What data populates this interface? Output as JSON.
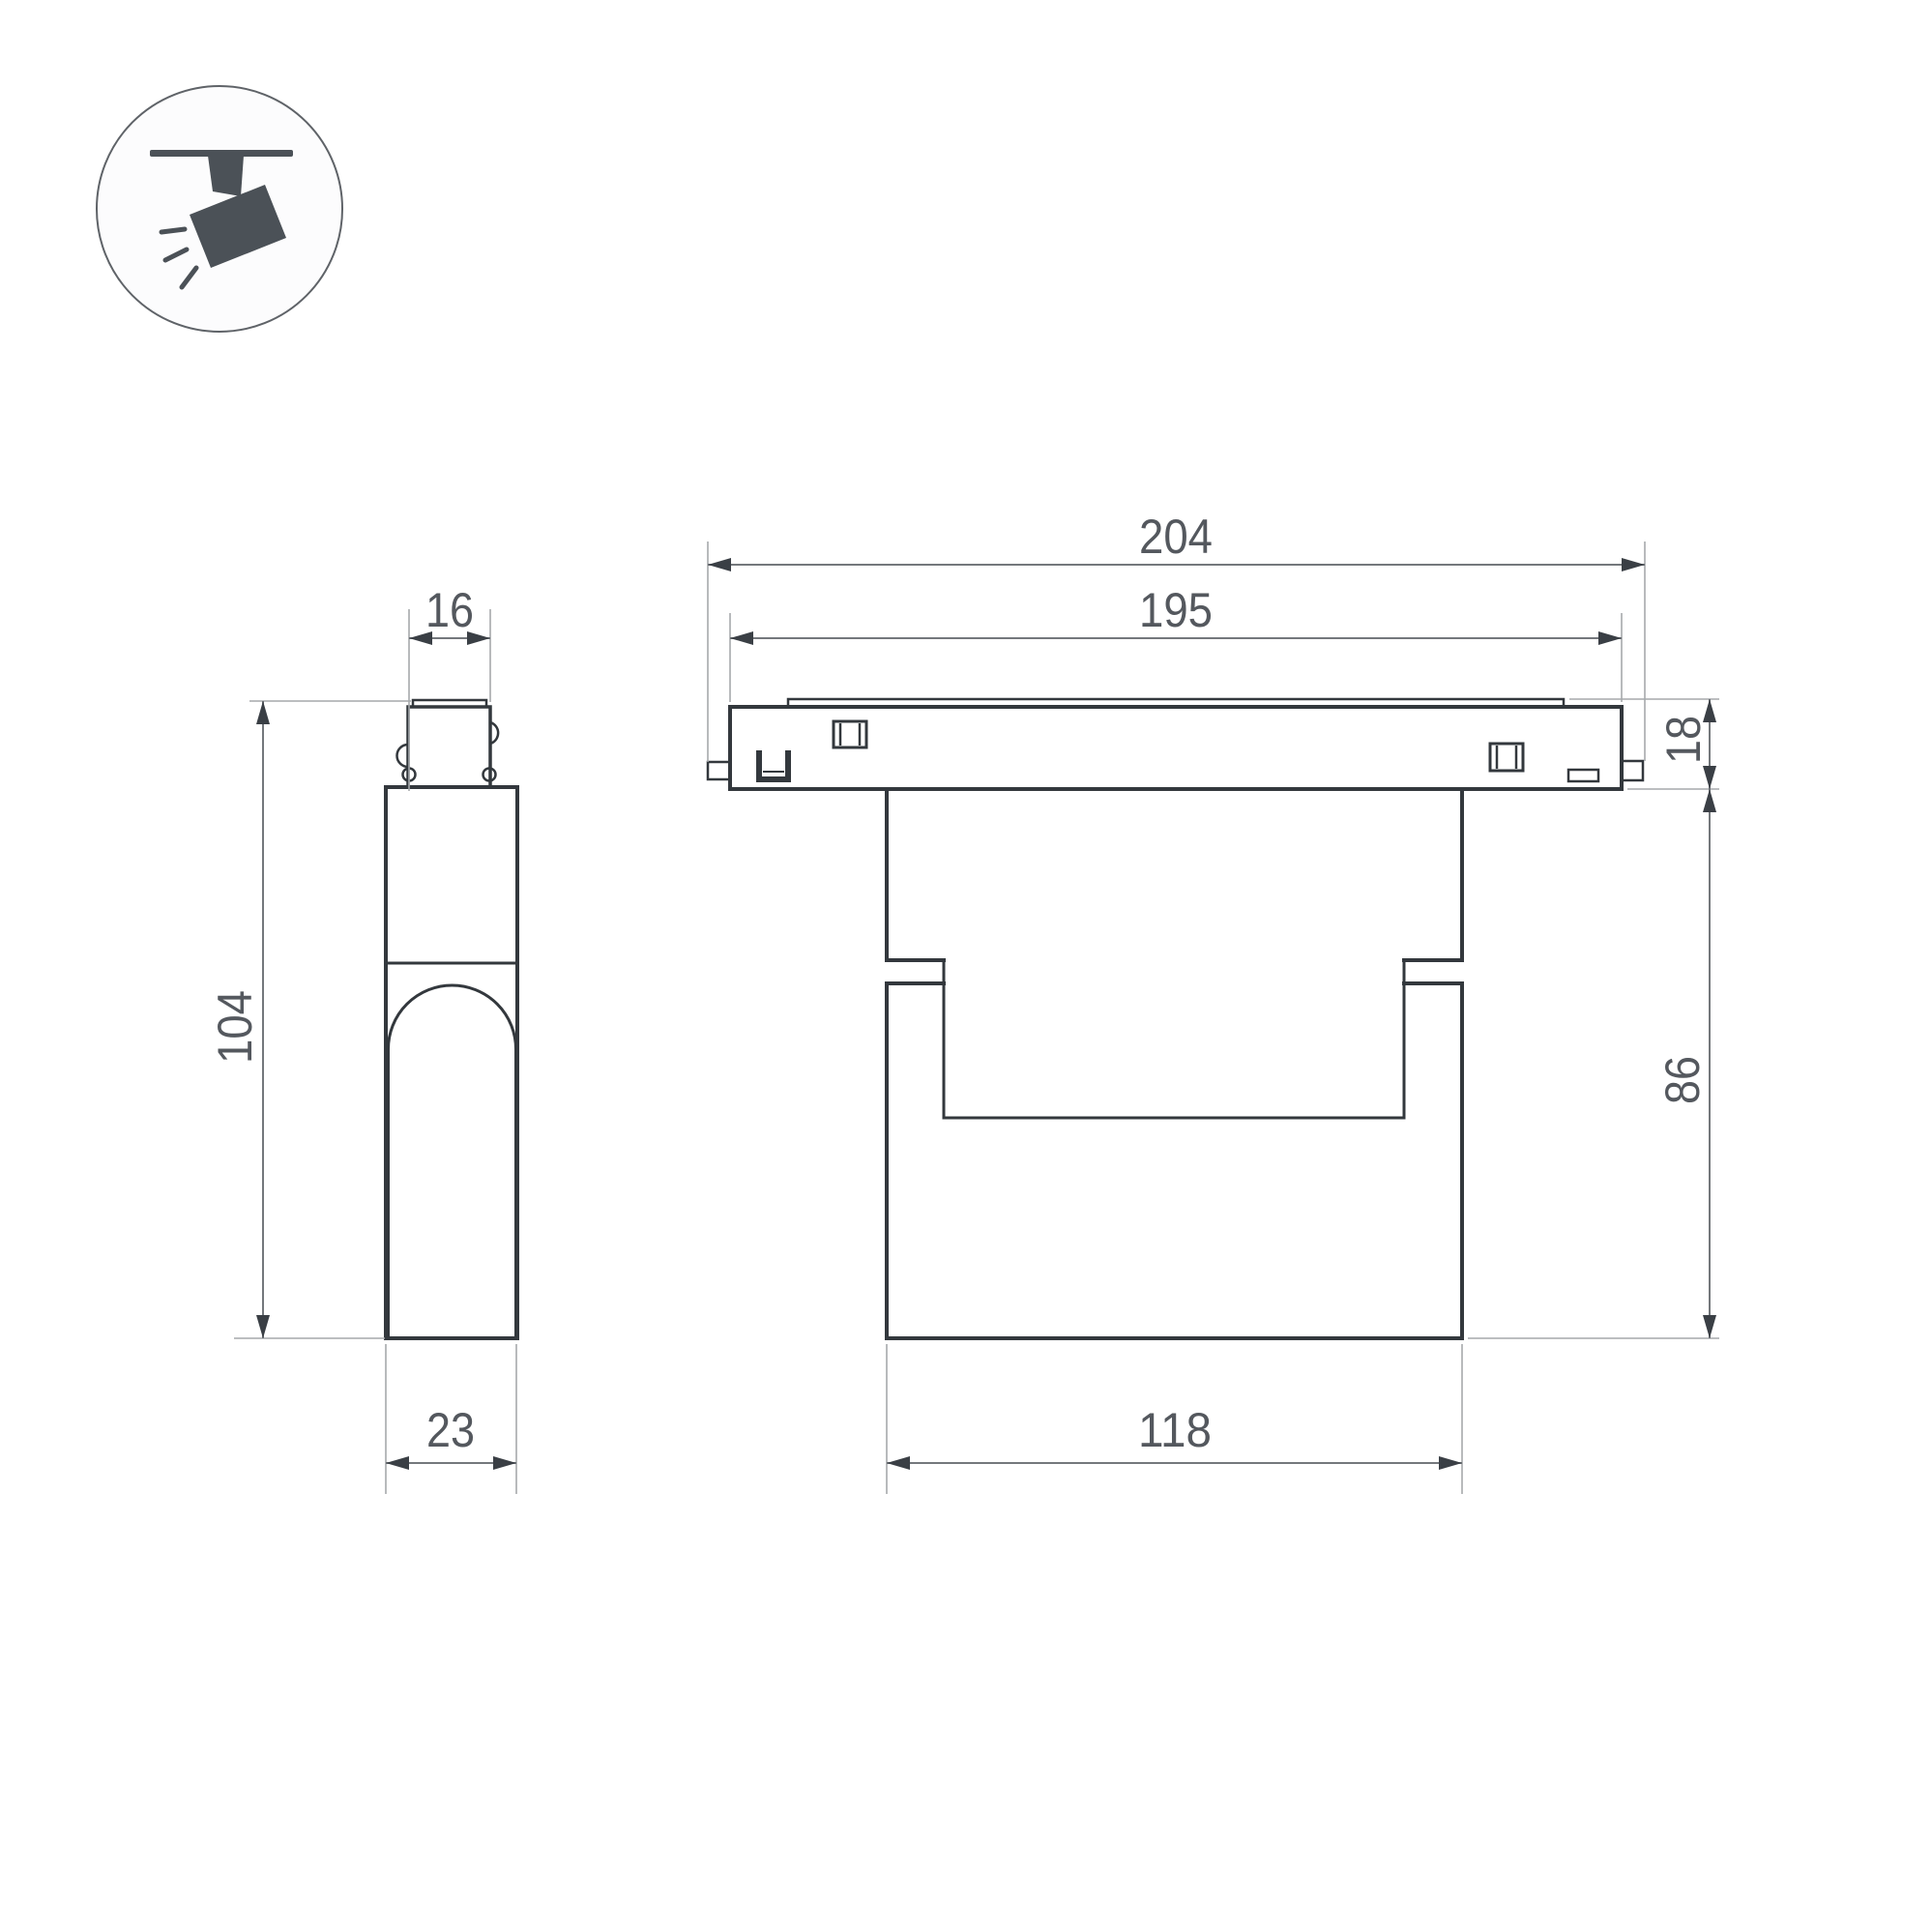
{
  "meta": {
    "title": "Track spotlight dimensional drawing",
    "icon": "track-spotlight-icon",
    "colors": {
      "background": "#ffffff",
      "outline": "#33383d",
      "dimension_line": "#74787c",
      "extension_line": "#a6a9ac",
      "text": "#54585e",
      "icon_fill": "#4b5157"
    }
  },
  "dimensions": {
    "overall_width": "204",
    "track_length": "195",
    "track_height": "18",
    "body_height": "86",
    "body_width": "118",
    "side_top_width": "16",
    "side_height": "104",
    "side_depth": "23"
  }
}
